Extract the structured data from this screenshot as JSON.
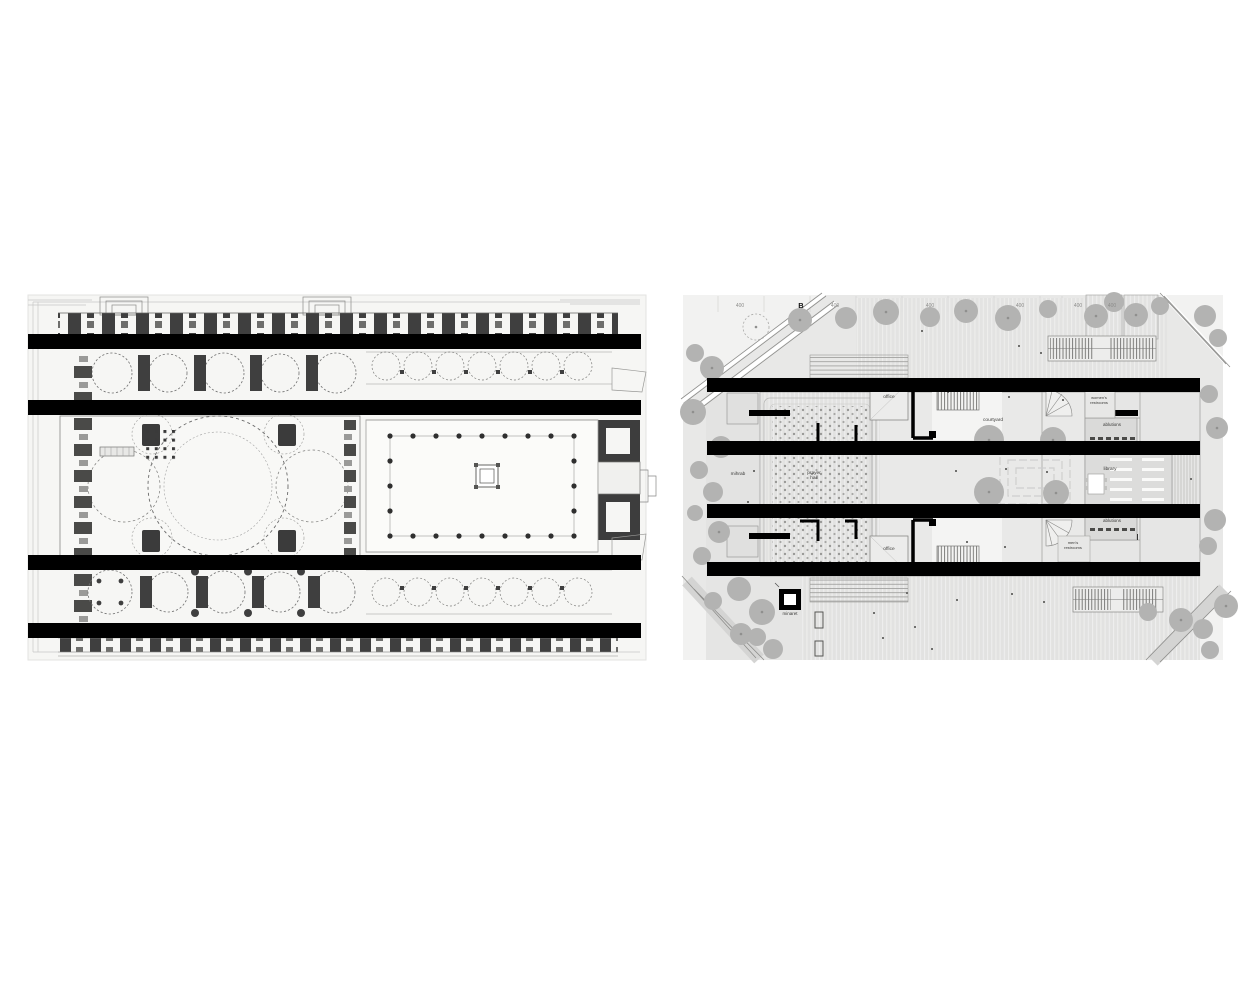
{
  "right_plan": {
    "section_marker": "B",
    "dimension_labels": [
      "400",
      "400",
      "400",
      "400",
      "400",
      "400"
    ],
    "rooms": {
      "office_top": "office",
      "womens_restrooms_line1": "women's",
      "womens_restrooms_line2": "restrooms",
      "courtyard": "courtyard",
      "ablutions_top": "ablutions",
      "mihrab": "mihrab",
      "prayer_hall_line1": "prayer",
      "prayer_hall_line2": "hall",
      "library": "library",
      "ablutions_bottom": "ablutions",
      "mens_restrooms_line1": "men's",
      "mens_restrooms_line2": "restrooms",
      "office_bottom": "office",
      "minaret": "minaret"
    }
  },
  "colors": {
    "redaction_bar": "#000000",
    "site_ground": "#e8e8e7",
    "tree_canopy": "#b3b3b2",
    "plan_poche": "#3f3f3f",
    "building_wall": "#000000"
  }
}
